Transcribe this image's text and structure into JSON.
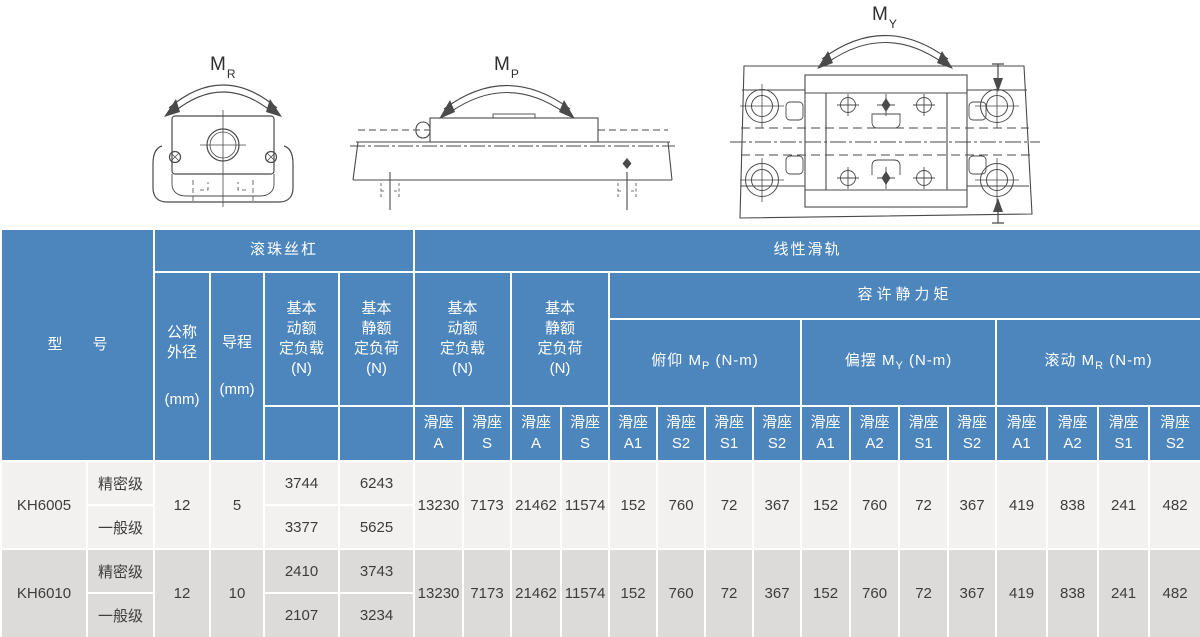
{
  "diagrams": {
    "mr": {
      "main": "M",
      "sub": "R"
    },
    "mp": {
      "main": "M",
      "sub": "P"
    },
    "my": {
      "main": "M",
      "sub": "Y"
    }
  },
  "table": {
    "top_header": {
      "model": "型　　号",
      "ball_screw": "滚珠丝杠",
      "linear_guide": "线性滑轨"
    },
    "ball_screw_cols": {
      "nominal_od_title": "公称\n外径",
      "nominal_od_unit": "(mm)",
      "lead_title": "导程",
      "lead_unit": "(mm)",
      "dynamic_load": "基本\n动额\n定负载\n(N)",
      "static_load": "基本\n静额\n定负荷\n(N)"
    },
    "linear_guide_cols": {
      "dynamic_load": "基本\n动额\n定负载\n(N)",
      "static_load": "基本\n静额\n定负荷\n(N)",
      "allowable_moment": "容许静力矩",
      "pitch": {
        "prefix": "俯仰 M",
        "sub": "P",
        "suffix": " (N-m)"
      },
      "yaw": {
        "prefix": "偏摆 M",
        "sub": "Y",
        "suffix": " (N-m)"
      },
      "roll": {
        "prefix": "滚动 M",
        "sub": "R",
        "suffix": " (N-m)"
      }
    },
    "slider_cols": [
      "滑座\nA",
      "滑座\nS",
      "滑座\nA",
      "滑座\nS",
      "滑座\nA1",
      "滑座\nS2",
      "滑座\nS1",
      "滑座\nS2",
      "滑座\nA1",
      "滑座\nA2",
      "滑座\nS1",
      "滑座\nS2",
      "滑座\nA1",
      "滑座\nA2",
      "滑座\nS1",
      "滑座\nS2"
    ],
    "rows": [
      {
        "model": "KH6005",
        "grades": [
          "精密级",
          "一般级"
        ],
        "nominal_od": "12",
        "lead": "5",
        "dyn": [
          "3744",
          "3377"
        ],
        "stat": [
          "6243",
          "5625"
        ],
        "lg": [
          "13230",
          "7173",
          "21462",
          "11574",
          "152",
          "760",
          "72",
          "367",
          "152",
          "760",
          "72",
          "367",
          "419",
          "838",
          "241",
          "482"
        ]
      },
      {
        "model": "KH6010",
        "grades": [
          "精密级",
          "一般级"
        ],
        "nominal_od": "12",
        "lead": "10",
        "dyn": [
          "2410",
          "2107"
        ],
        "stat": [
          "3743",
          "3234"
        ],
        "lg": [
          "13230",
          "7173",
          "21462",
          "11574",
          "152",
          "760",
          "72",
          "367",
          "152",
          "760",
          "72",
          "367",
          "419",
          "838",
          "241",
          "482"
        ]
      }
    ]
  },
  "colors": {
    "header_blue": "#4d86bd",
    "row_light": "#f2f1ef",
    "row_dark": "#dcdbd9",
    "line_gray": "#4a4a4a"
  }
}
